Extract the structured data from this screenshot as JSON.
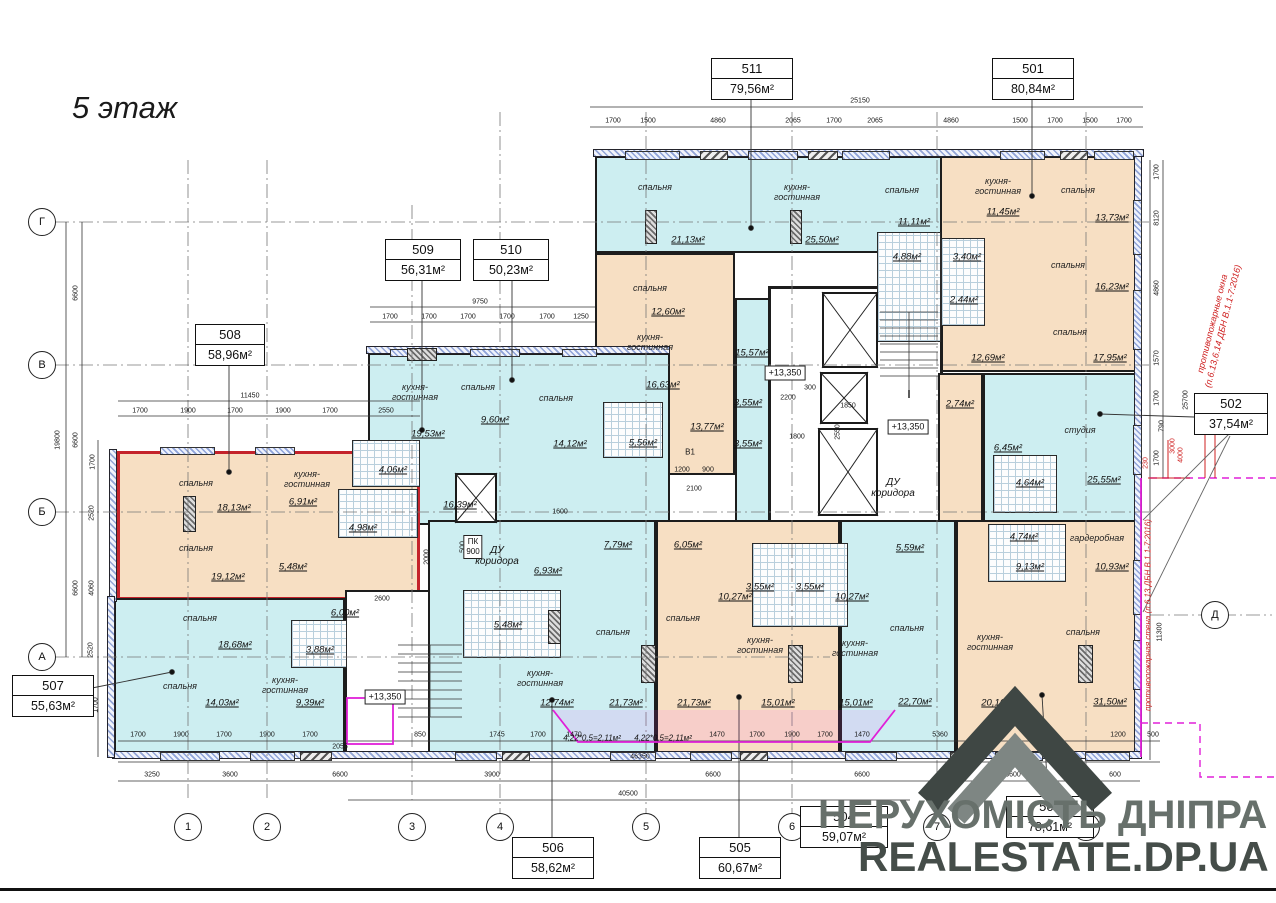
{
  "title": "5 этаж",
  "watermark": {
    "line1": "НЕРУХОМІСТЬ ДНІПРА",
    "line2": "REALESTATE.DP.UA"
  },
  "apartments": [
    {
      "id": "511",
      "area": "79,56м²"
    },
    {
      "id": "501",
      "area": "80,84м²"
    },
    {
      "id": "509",
      "area": "56,31м²"
    },
    {
      "id": "510",
      "area": "50,23м²"
    },
    {
      "id": "508",
      "area": "58,96м²"
    },
    {
      "id": "502",
      "area": "37,54м²"
    },
    {
      "id": "507",
      "area": "55,63м²"
    },
    {
      "id": "506",
      "area": "58,62м²"
    },
    {
      "id": "505",
      "area": "60,67м²"
    },
    {
      "id": "504",
      "area": "59,07м²"
    },
    {
      "id": "503",
      "area": "78,61м²"
    }
  ],
  "rooms": [
    {
      "name": "спальня",
      "area": "21,13м²"
    },
    {
      "name": "кухня-гостинная",
      "area": "25,50м²"
    },
    {
      "name": "спальня",
      "area": "11,11м²"
    },
    {
      "name": "",
      "area": "4,88м²"
    },
    {
      "name": "кухня-гостинная",
      "area": "11,45м²"
    },
    {
      "name": "спальня",
      "area": "13,73м²"
    },
    {
      "name": "",
      "area": "3,40м²"
    },
    {
      "name": "",
      "area": "2,44м²"
    },
    {
      "name": "спальня",
      "area": "16,23м²"
    },
    {
      "name": "спальня",
      "area": "17,95м²"
    },
    {
      "name": "",
      "area": "12,69м²"
    },
    {
      "name": "",
      "area": "2,74м²"
    },
    {
      "name": "спальня",
      "area": "12,60м²"
    },
    {
      "name": "кухня-гостинная",
      "area": "16,63м²"
    },
    {
      "name": "",
      "area": "13,77м²"
    },
    {
      "name": "",
      "area": "15,57м²"
    },
    {
      "name": "",
      "area": "3,55м²"
    },
    {
      "name": "",
      "area": "3,55м²"
    },
    {
      "name": "кухня-гостинная",
      "area": "19,53м²"
    },
    {
      "name": "спальня",
      "area": "9,60м²"
    },
    {
      "name": "спальня",
      "area": "14,12м²"
    },
    {
      "name": "",
      "area": "16,39м²"
    },
    {
      "name": "",
      "area": "4,06м²"
    },
    {
      "name": "",
      "area": "5,56м²"
    },
    {
      "name": "спальня",
      "area": "18,13м²"
    },
    {
      "name": "кухня-гостинная",
      "area": "6,91м²"
    },
    {
      "name": "",
      "area": "4,98м²"
    },
    {
      "name": "спальня",
      "area": "19,12м²"
    },
    {
      "name": "",
      "area": "5,48м²"
    },
    {
      "name": "студия",
      "area": "25,55м²"
    },
    {
      "name": "",
      "area": "6,45м²"
    },
    {
      "name": "",
      "area": "4,64м²"
    },
    {
      "name": "",
      "area": "4,74м²"
    },
    {
      "name": "гардеробная",
      "area": "10,93м²"
    },
    {
      "name": "",
      "area": "9,13м²"
    },
    {
      "name": "кухня-гостинная",
      "area": "20,16м²"
    },
    {
      "name": "спальня",
      "area": "31,50м²"
    },
    {
      "name": "спальня",
      "area": "22,70м²"
    },
    {
      "name": "",
      "area": "5,59м²"
    },
    {
      "name": "",
      "area": "10,27м²"
    },
    {
      "name": "",
      "area": "10,27м²"
    },
    {
      "name": "",
      "area": "3,55м²"
    },
    {
      "name": "",
      "area": "3,55м²"
    },
    {
      "name": "спальня",
      "area": "21,73м²"
    },
    {
      "name": "спальня",
      "area": "21,73м²"
    },
    {
      "name": "кухня-гостинная",
      "area": "12,74м²"
    },
    {
      "name": "кухня-гостинная",
      "area": "15,01м²"
    },
    {
      "name": "кухня-гостинная",
      "area": "15,01м²"
    },
    {
      "name": "",
      "area": "7,79м²"
    },
    {
      "name": "",
      "area": "6,05м²"
    },
    {
      "name": "",
      "area": "6,93м²"
    },
    {
      "name": "",
      "area": "5,48м²"
    },
    {
      "name": "спальня",
      "area": "18,68м²"
    },
    {
      "name": "спальня",
      "area": "14,03м²"
    },
    {
      "name": "кухня-гостинная",
      "area": "9,39м²"
    },
    {
      "name": "",
      "area": "3,88м²"
    },
    {
      "name": "",
      "area": "6,00м²"
    }
  ],
  "axes": {
    "left": [
      "Г",
      "В",
      "Б",
      "А"
    ],
    "right": [
      "Д"
    ],
    "bottom": [
      "1",
      "2",
      "3",
      "4",
      "5",
      "6",
      "7",
      "8"
    ]
  },
  "notes": {
    "fire_windows_1": "противопожарные окна",
    "fire_windows_2": "(п.6.13,6.14 ДБН В.1.1-7:2016)",
    "fire_wall": "противопожарная стена (п.6.13 ДБН В.1.1-7:2016)",
    "balcony": [
      "4,22*0,5=2,11м²",
      "4,22*0,5=2,11м²"
    ]
  },
  "misc": {
    "level": "+13,350",
    "du_line1": "ДУ",
    "du_line2": "коридора",
    "pk": "ПК",
    "pk_val": "900",
    "v1": "В1"
  },
  "dims": {
    "top_total": "25150",
    "top": [
      "1700",
      "1500",
      "4860",
      "2065",
      "1700",
      "2065",
      "4860",
      "1500",
      "1700",
      "1500",
      "1700"
    ],
    "r508_total": "11450",
    "r508": [
      "1700",
      "1900",
      "1700",
      "1900",
      "1700",
      "2550"
    ],
    "r509_total": "9750",
    "r509": [
      "1700",
      "1700",
      "1700",
      "1700",
      "1700",
      "1250"
    ],
    "left": [
      "19800",
      "6600",
      "6600",
      "6600",
      "1700",
      "2520",
      "4060",
      "2520",
      "1700"
    ],
    "right": [
      "1700",
      "8120",
      "4860",
      "1570",
      "1700",
      "790",
      "1700",
      "25700",
      "11300"
    ],
    "right_red": [
      "230",
      "3000",
      "4000"
    ],
    "b1": [
      "1700",
      "1900",
      "1700",
      "1900",
      "1700",
      "2055",
      "850",
      "1745",
      "1700",
      "1470",
      "1470",
      "1700",
      "1900",
      "1700",
      "1470",
      "5360",
      "1200",
      "500"
    ],
    "b1_total": "46350",
    "b2": [
      "3250",
      "3600",
      "6600",
      "3900",
      "6600",
      "6600",
      "6600",
      "600"
    ],
    "b2_total": "40500",
    "inner": [
      "1200",
      "900",
      "2100",
      "1800",
      "2200",
      "300",
      "1850",
      "2550",
      "2600",
      "2000",
      "1600",
      "500"
    ]
  }
}
